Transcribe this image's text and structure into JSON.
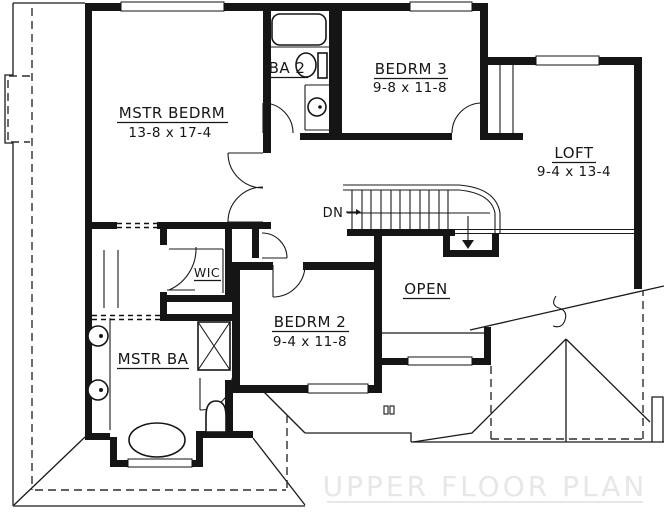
{
  "plan": {
    "title": "UPPER FLOOR PLAN",
    "rooms": {
      "mstr_bedrm": {
        "name": "MSTR BEDRM",
        "dims": "13-8 x 17-4"
      },
      "ba2": {
        "name": "BA 2"
      },
      "bedrm3": {
        "name": "BEDRM 3",
        "dims": "9-8 x 11-8"
      },
      "loft": {
        "name": "LOFT",
        "dims": "9-4 x 13-4"
      },
      "wic": {
        "name": "WIC"
      },
      "mstr_ba": {
        "name": "MSTR BA"
      },
      "bedrm2": {
        "name": "BEDRM 2",
        "dims": "9-4 x 11-8"
      },
      "open": {
        "name": "OPEN"
      }
    },
    "stairs": {
      "down_label": "DN"
    },
    "fixtures": [
      "bathtub",
      "toilet",
      "sink",
      "double-vanity-sinks",
      "shower-stall",
      "oval-tub",
      "closet-shelves"
    ],
    "colors": {
      "wall": "#151515",
      "line": "#1a1a1a",
      "background": "#ffffff",
      "title_watermark": "#e7e7e7"
    }
  }
}
